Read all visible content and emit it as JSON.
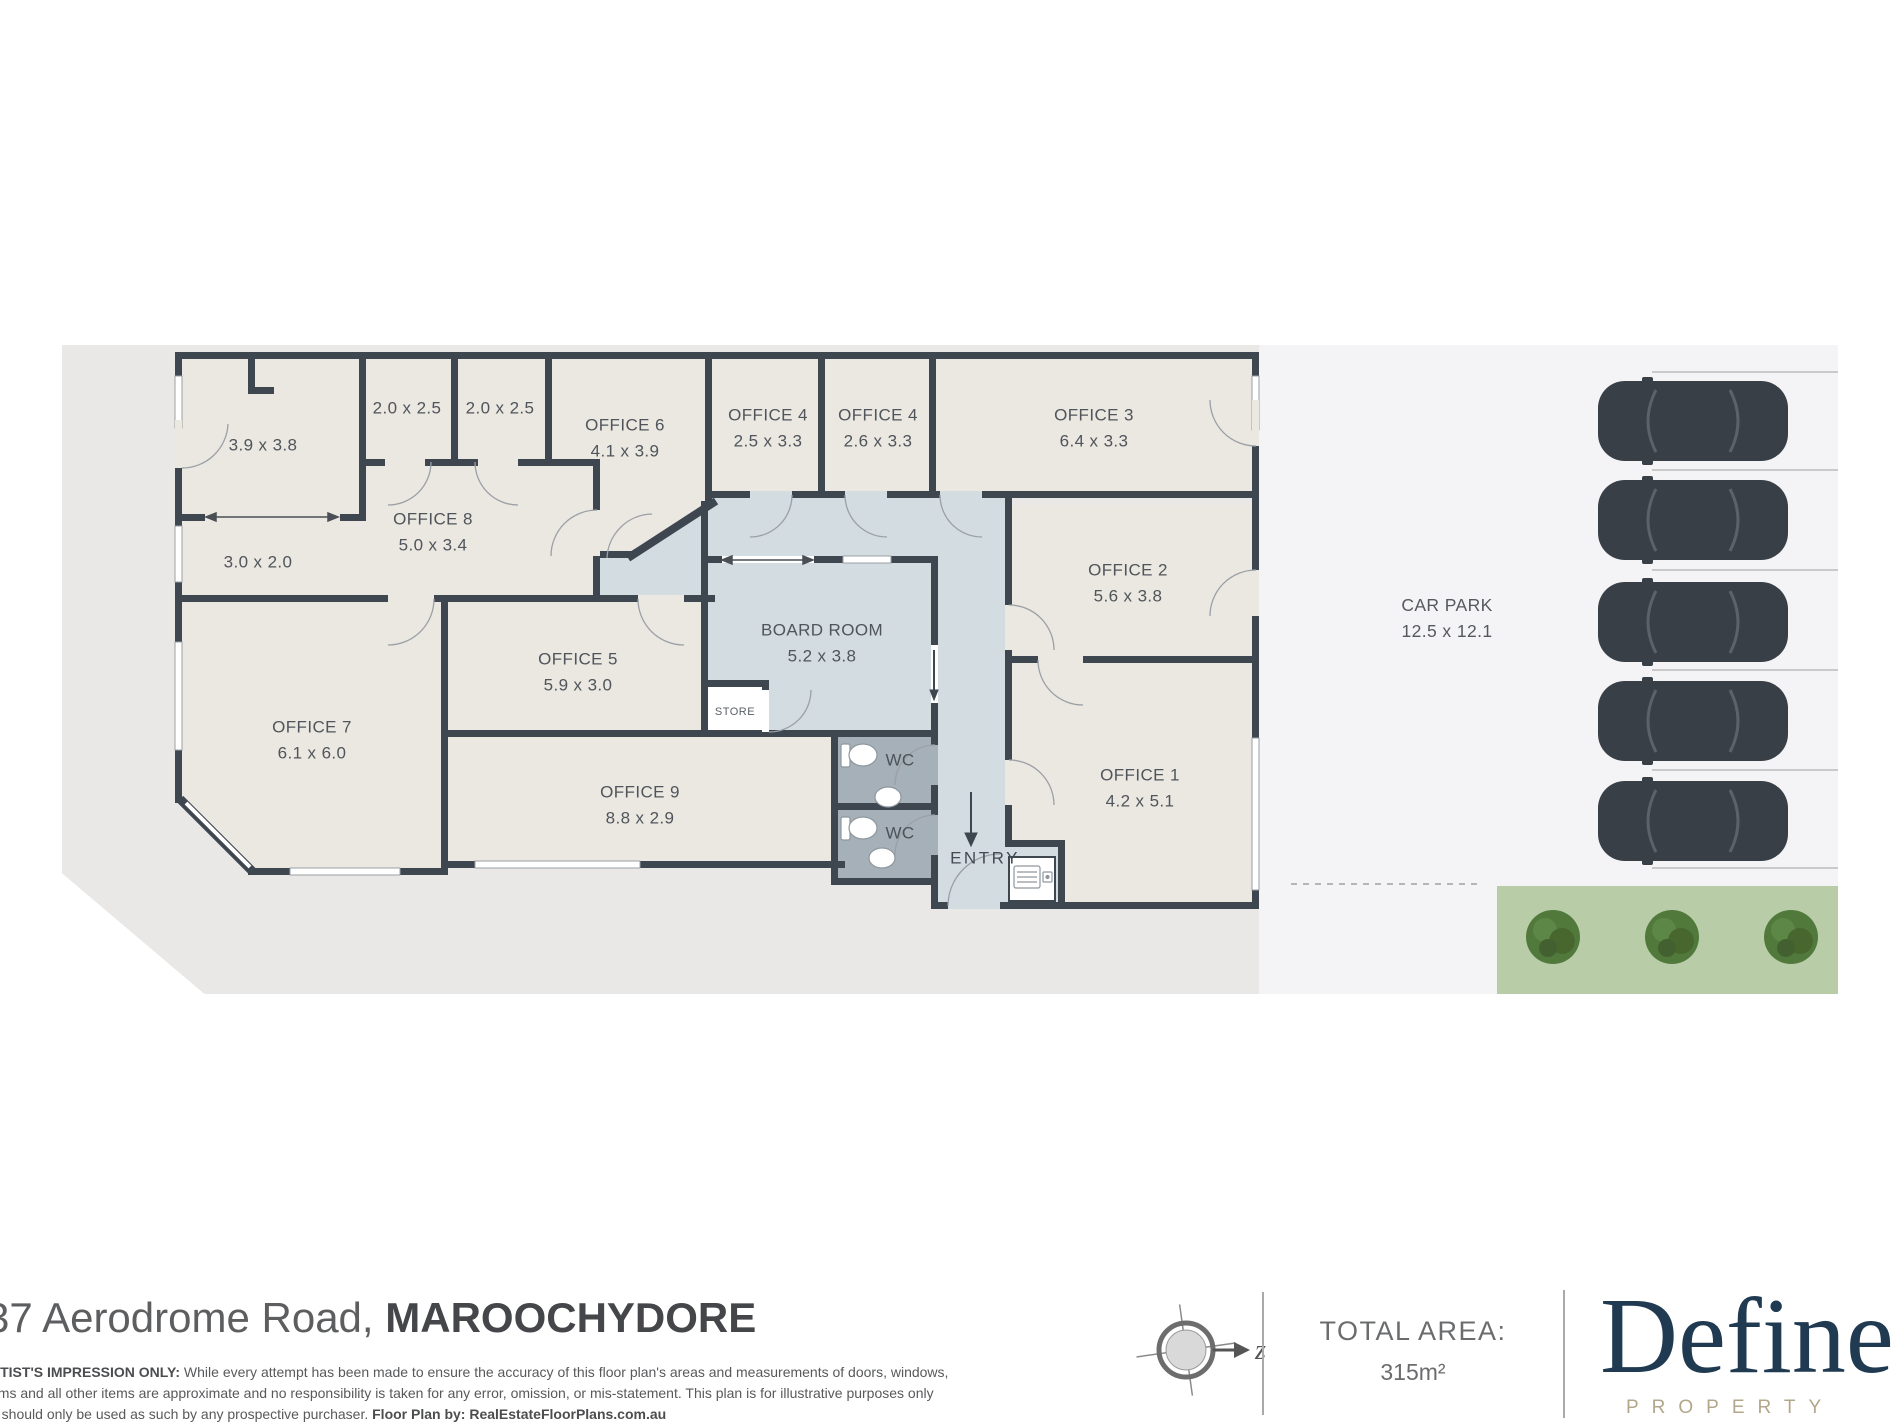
{
  "colors": {
    "wall": "#3e4650",
    "room_fill": "#ebe7e1",
    "corridor_fill": "#d3dce1",
    "wc_fill": "#a6b0b8",
    "parcel": "#e9e8e7",
    "carpark_area": "#f4f4f6",
    "grass": "#b8cda7",
    "tree": "#4c7438",
    "car": "#393f47",
    "brand_navy": "#203a52",
    "brand_gold": "#b2a78a"
  },
  "plan": {
    "rooms": {
      "r3938": {
        "dims": "3.9 x 3.8"
      },
      "r2025a": {
        "dims": "2.0 x 2.5"
      },
      "r2025b": {
        "dims": "2.0 x 2.5"
      },
      "office6": {
        "name": "OFFICE 6",
        "dims": "4.1 x 3.9"
      },
      "office4a": {
        "name": "OFFICE 4",
        "dims": "2.5 x 3.3"
      },
      "office4b": {
        "name": "OFFICE 4",
        "dims": "2.6 x 3.3"
      },
      "office3": {
        "name": "OFFICE 3",
        "dims": "6.4 x 3.3"
      },
      "office8": {
        "name": "OFFICE 8",
        "dims": "5.0 x 3.4"
      },
      "r3020": {
        "dims": "3.0 x 2.0"
      },
      "office2": {
        "name": "OFFICE 2",
        "dims": "5.6 x 3.8"
      },
      "office5": {
        "name": "OFFICE 5",
        "dims": "5.9 x 3.0"
      },
      "boardroom": {
        "name": "BOARD ROOM",
        "dims": "5.2 x 3.8"
      },
      "store": {
        "name": "STORE"
      },
      "office7": {
        "name": "OFFICE 7",
        "dims": "6.1 x 6.0"
      },
      "office9": {
        "name": "OFFICE 9",
        "dims": "8.8 x 2.9"
      },
      "wc1": {
        "name": "WC"
      },
      "wc2": {
        "name": "WC"
      },
      "entry": {
        "name": "ENTRY"
      },
      "office1": {
        "name": "OFFICE 1",
        "dims": "4.2 x 5.1"
      }
    },
    "carpark": {
      "name": "CAR PARK",
      "dims": "12.5 x 12.1",
      "car_count": 5,
      "tree_count": 3
    }
  },
  "footer": {
    "address": "37 Aerodrome Road, ",
    "suburb": "MAROOCHYDORE",
    "disclaimer_bold": "RTIST'S IMPRESSION ONLY:",
    "disclaimer_line1": " While every attempt has been made to ensure the accuracy of this floor plan's areas and measurements of doors, windows,",
    "disclaimer_line2": "oms and all other items are approximate and no responsibility is taken for any error, omission, or mis-statement. This plan is for illustrative purposes only",
    "disclaimer_line3": "d should only be used as such by any prospective purchaser. ",
    "disclaimer_credit": "Floor Plan by: RealEstateFloorPlans.com.au",
    "compass_letter": "z",
    "total_area_label": "TOTAL AREA:",
    "total_area_value": "315m²",
    "brand_name": "Define",
    "brand_sub": "PROPERTY"
  }
}
